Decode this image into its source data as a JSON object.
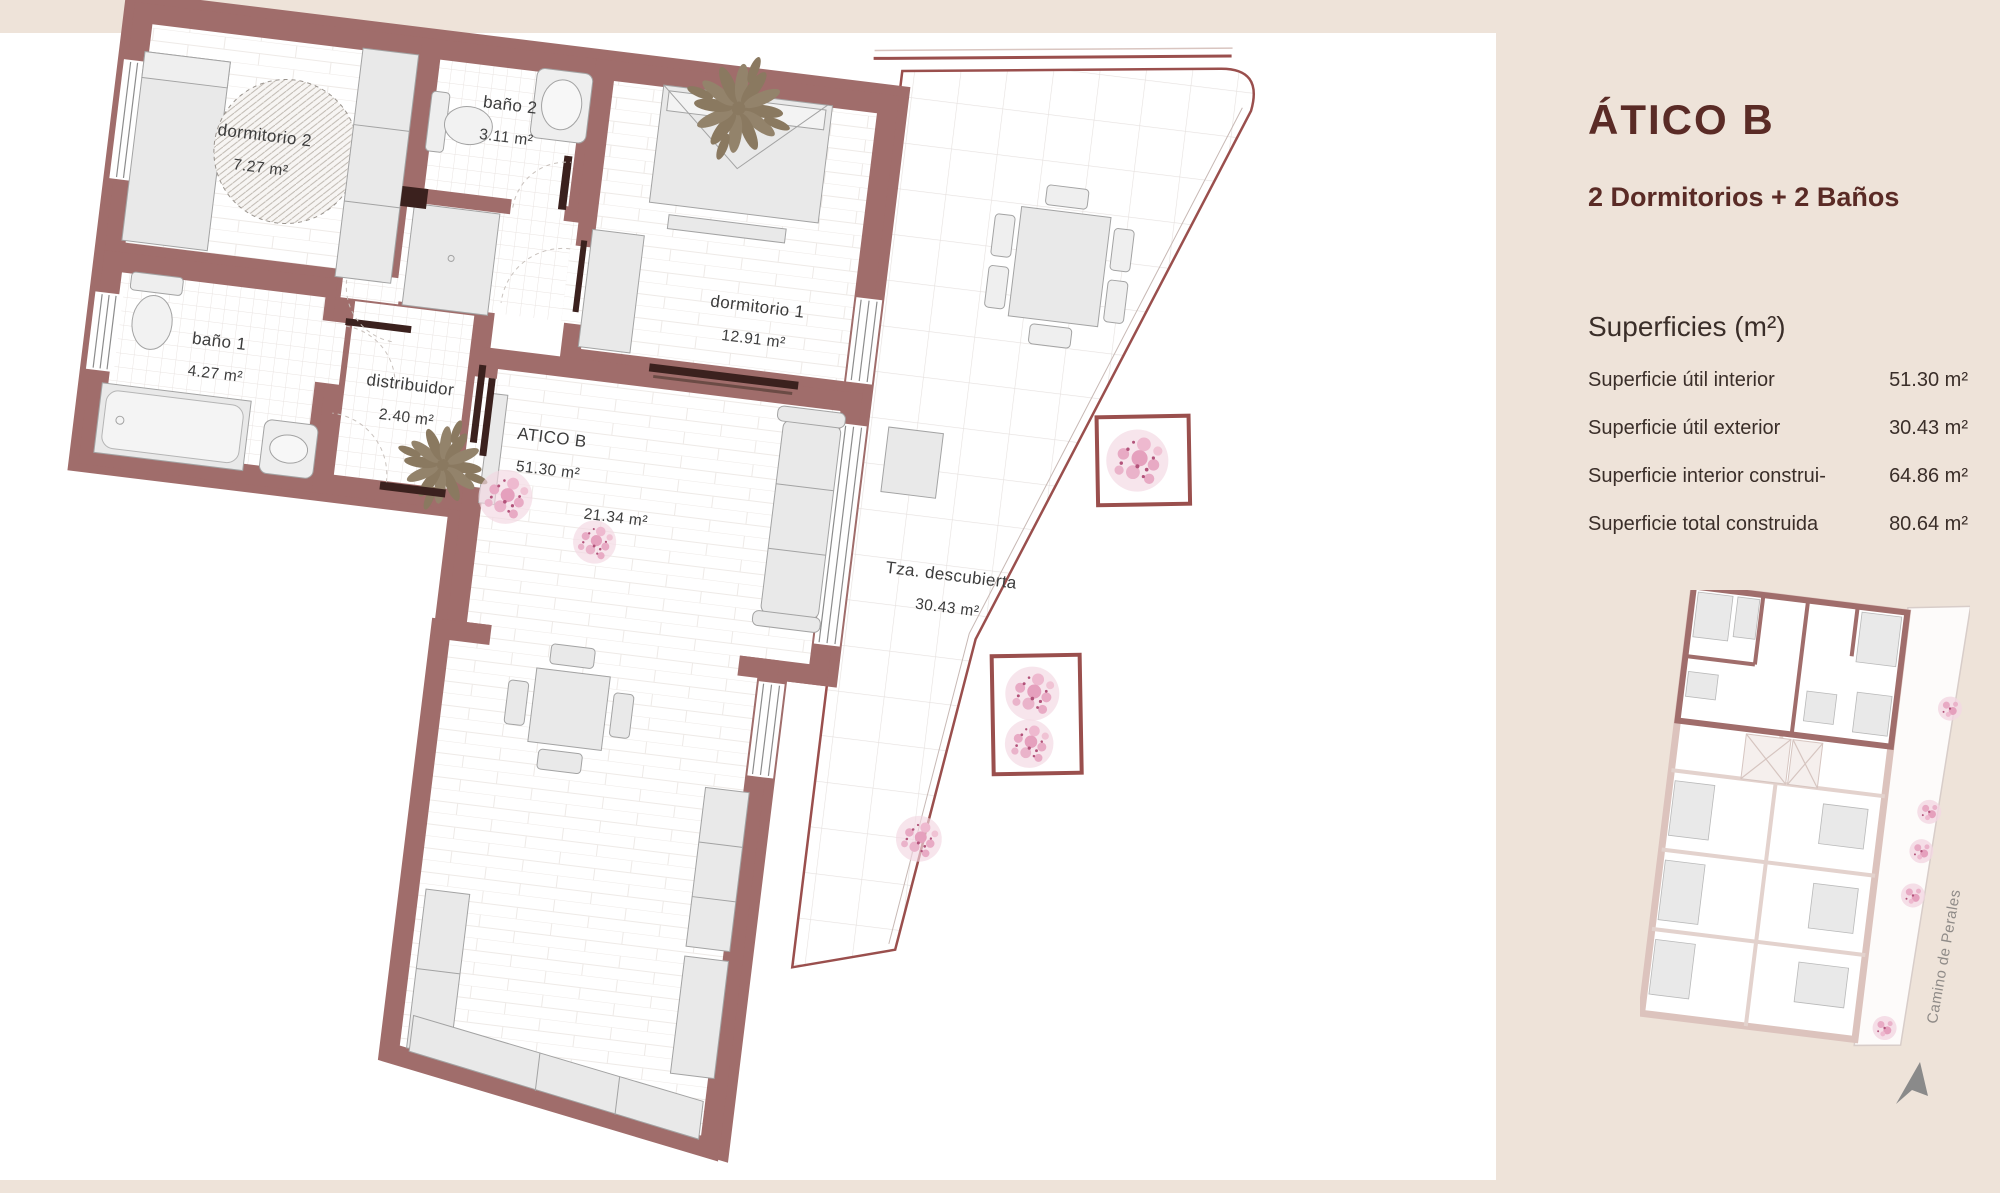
{
  "panel": {
    "title": "ÁTICO B",
    "subtitle": "2 Dormitorios + 2 Baños",
    "superficies_heading": "Superficies (m²)",
    "rows": [
      {
        "label": "Superficie útil interior",
        "value": "51.30 m²"
      },
      {
        "label": "Superficie útil exterior",
        "value": "30.43 m²"
      },
      {
        "label": "Superficie interior construi-",
        "value": "64.86 m²"
      },
      {
        "label": "Superficie total construida",
        "value": "80.64 m²"
      }
    ]
  },
  "plan": {
    "labels": {
      "dormitorio2": {
        "name": "dormitorio 2",
        "area": "7.27  m²"
      },
      "bano2": {
        "name": "baño 2",
        "area": "3.11  m²"
      },
      "dormitorio1": {
        "name": "dormitorio 1",
        "area": "12.91  m²"
      },
      "bano1": {
        "name": "baño 1",
        "area": "4.27  m²"
      },
      "distribuidor": {
        "name": "distribuidor",
        "area": "2.40  m²"
      },
      "atico": {
        "name": "ATICO B",
        "area": "51.30  m²"
      },
      "salon_area": "21.34  m²",
      "terraza": {
        "name": "Tza. descubierta",
        "area": "30.43  m²"
      }
    }
  },
  "miniplan": {
    "street": "Camino de Perales"
  },
  "colors": {
    "background_beige": "#eee3d9",
    "sheet_white": "#ffffff",
    "wall_red": "#a06d6b",
    "door_dark": "#3b211e",
    "title_maroon": "#5a2b26",
    "text_dark": "#3a2e29",
    "furniture_gray": "#e9e9e9",
    "tree_olive": "#8a7960",
    "flower_pink": "#e8aac4",
    "miniplan_pink": "#dcc3bd",
    "street_gray": "#8f8b88",
    "north_arrow_gray": "#8a8a8a"
  }
}
